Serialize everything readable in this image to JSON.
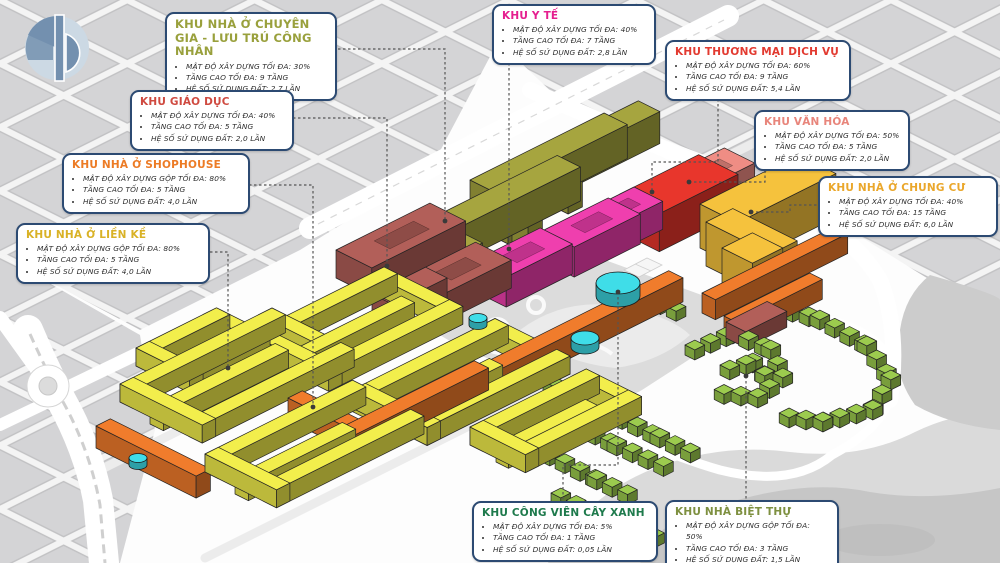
{
  "logo": {
    "primary_color": "#7390af",
    "secondary_color": "#ccd9e4"
  },
  "map": {
    "zone_colors": {
      "olive": "#a6a53f",
      "magenta": "#ef3fae",
      "red": "#e8362c",
      "salmon": "#ef8d84",
      "gold": "#f5c23d",
      "maroon": "#b25f59",
      "orange": "#f07c2c",
      "yellow": "#f2ee4c",
      "green": "#9ccb4e",
      "water": "#3fdde8"
    },
    "background": {
      "block_fill": "#d4d4d6",
      "road_fill": "#ffffff",
      "terrain_fill": "#cccccc",
      "park_fill": "#dcdcdc"
    }
  },
  "callouts": [
    {
      "id": "khu-nha-o-chuyen-gia",
      "title": "KHU NHÀ Ở CHUYÊN GIA - LƯU TRÚ CÔNG NHÂN",
      "color": "#99a03c",
      "items": [
        "MẬT ĐỘ XÂY DỰNG TỐI ĐA: 30%",
        "TẦNG CAO TỐI ĐA: 9 TẦNG",
        "HỆ SỐ SỬ DỤNG ĐẤT: 2,7 LẦN"
      ]
    },
    {
      "id": "khu-y-te",
      "title": "KHU Y TẾ",
      "color": "#e51f8f",
      "items": [
        "MẬT ĐỘ XÂY DỰNG TỐI ĐA: 40%",
        "TẦNG CAO TỐI ĐA: 7 TẦNG",
        "HỆ SỐ SỬ DỤNG ĐẤT: 2,8 LẦN"
      ]
    },
    {
      "id": "khu-thuong-mai-dich-vu",
      "title": "KHU THƯƠNG MẠI DỊCH VỤ",
      "color": "#e23a30",
      "items": [
        "MẬT ĐỘ XÂY DỰNG TỐI ĐA: 60%",
        "TẦNG CAO TỐI ĐA: 9 TẦNG",
        "HỆ SỐ SỬ DỤNG ĐẤT: 5,4 LẦN"
      ]
    },
    {
      "id": "khu-giao-duc",
      "title": "KHU GIÁO DỤC",
      "color": "#cf4a40",
      "items": [
        "MẬT ĐỘ XÂY DỰNG TỐI ĐA: 40%",
        "TẦNG CAO TỐI ĐA: 5 TẦNG",
        "HỆ SỐ SỬ DỤNG ĐẤT: 2,0 LẦN"
      ]
    },
    {
      "id": "khu-van-hoa",
      "title": "KHU VĂN HÓA",
      "color": "#e8857b",
      "items": [
        "MẬT ĐỘ XÂY DỰNG TỐI ĐA: 50%",
        "TẦNG CAO TỐI ĐA: 5 TẦNG",
        "HỆ SỐ SỬ DỤNG ĐẤT: 2,0 LẦN"
      ]
    },
    {
      "id": "khu-nha-o-shophouse",
      "title": "KHU NHÀ Ở SHOPHOUSE",
      "color": "#ec7b25",
      "items": [
        "MẬT ĐỘ XÂY DỰNG GỘP TỐI ĐA: 80%",
        "TẦNG CAO TỐI ĐA: 5 TẦNG",
        "HỆ SỐ SỬ DỤNG ĐẤT: 4,0 LẦN"
      ]
    },
    {
      "id": "khu-nha-o-lien-ke",
      "title": "KHU NHÀ Ở LIỀN KỀ",
      "color": "#d9b226",
      "items": [
        "MẬT ĐỘ XÂY DỰNG GỘP TỐI ĐA: 80%",
        "TẦNG CAO TỐI ĐA: 5 TẦNG",
        "HỆ SỐ SỬ DỤNG ĐẤT: 4,0 LẦN"
      ]
    },
    {
      "id": "khu-nha-o-chung-cu",
      "title": "KHU NHÀ Ở CHUNG CƯ",
      "color": "#eaa72b",
      "items": [
        "MẬT ĐỘ XÂY DỰNG TỐI ĐA: 40%",
        "TẦNG CAO TỐI ĐA: 15 TẦNG",
        "HỆ SỐ SỬ DỤNG ĐẤT: 6,0 LẦN"
      ]
    },
    {
      "id": "khu-cong-vien-cay-xanh",
      "title": "KHU CÔNG VIÊN CÂY XANH",
      "color": "#1e7a4c",
      "items": [
        "MẬT ĐỘ XÂY DỰNG TỐI ĐA: 5%",
        "TẦNG CAO TỐI ĐA: 1 TẦNG",
        "HỆ SỐ SỬ DỤNG ĐẤT: 0,05 LẦN"
      ]
    },
    {
      "id": "khu-nha-biet-thu",
      "title": "KHU NHÀ BIỆT THỰ",
      "color": "#7e9040",
      "items": [
        "MẬT ĐỘ XÂY DỰNG GỘP TỐI ĐA: 50%",
        "TẦNG CAO TỐI ĐA: 3 TẦNG",
        "HỆ SỐ SỬ DỤNG ĐẤT: 1,5 LẦN"
      ]
    }
  ]
}
